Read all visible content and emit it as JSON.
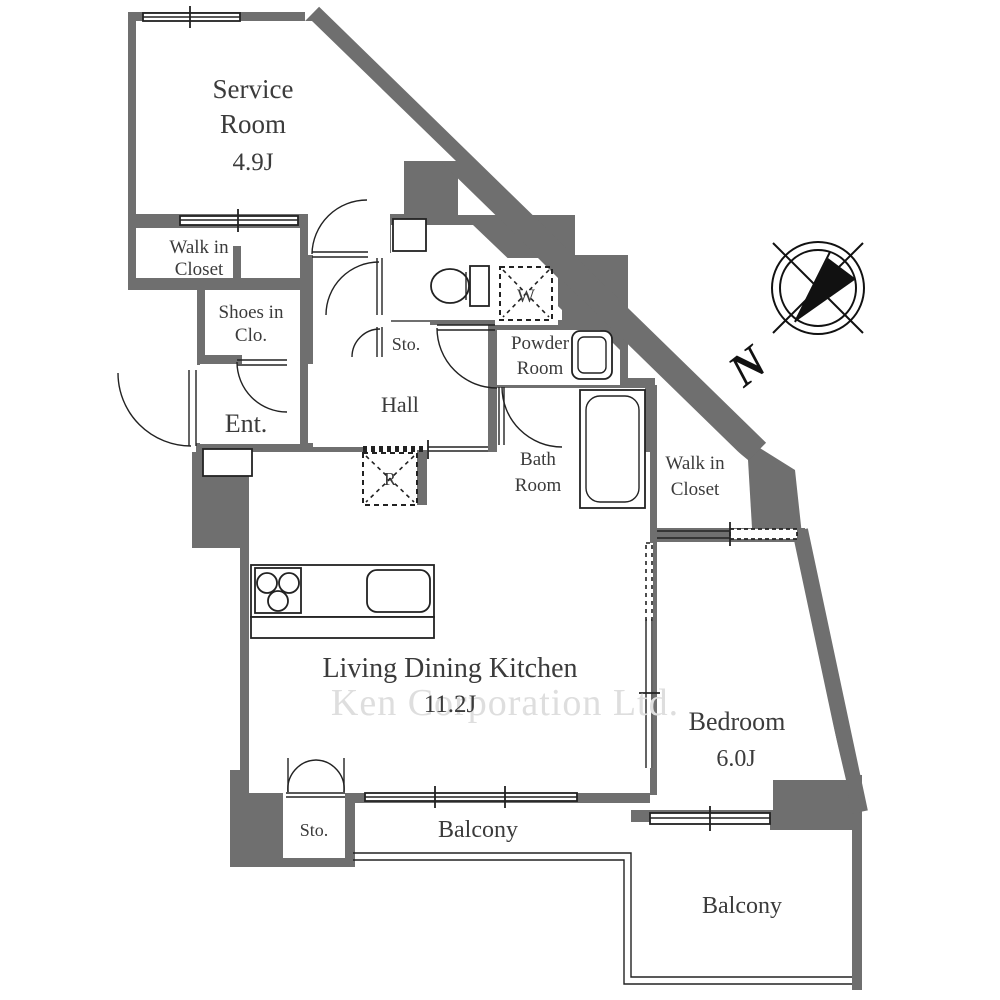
{
  "colors": {
    "wall": "#6f6f6f",
    "line": "#222222",
    "text": "#3b3b3b",
    "watermark": "#dedede"
  },
  "watermark": "Ken Corporation Ltd.",
  "compass": {
    "north_label": "N"
  },
  "rooms": {
    "service": {
      "lines": [
        "Service",
        "Room"
      ],
      "area": "4.9J"
    },
    "walk_in_closet_left": {
      "lines": [
        "Walk in",
        "Closet"
      ]
    },
    "shoes_in_closet": {
      "lines": [
        "Shoes in",
        "Clo."
      ]
    },
    "entrance": {
      "label": "Ent."
    },
    "hall": {
      "label": "Hall"
    },
    "storage_hall": {
      "label": "Sto."
    },
    "washing_machine": {
      "label": "W"
    },
    "powder_room": {
      "lines": [
        "Powder",
        "Room"
      ]
    },
    "bath_room": {
      "lines": [
        "Bath",
        "Room"
      ]
    },
    "walk_in_closet_right": {
      "lines": [
        "Walk in",
        "Closet"
      ]
    },
    "refrigerator": {
      "label": "R"
    },
    "living_dining_kitchen": {
      "label": "Living Dining Kitchen",
      "area": "11.2J"
    },
    "bedroom": {
      "label": "Bedroom",
      "area": "6.0J"
    },
    "storage_balcony": {
      "label": "Sto."
    },
    "balcony_left": {
      "label": "Balcony"
    },
    "balcony_right": {
      "label": "Balcony"
    }
  }
}
